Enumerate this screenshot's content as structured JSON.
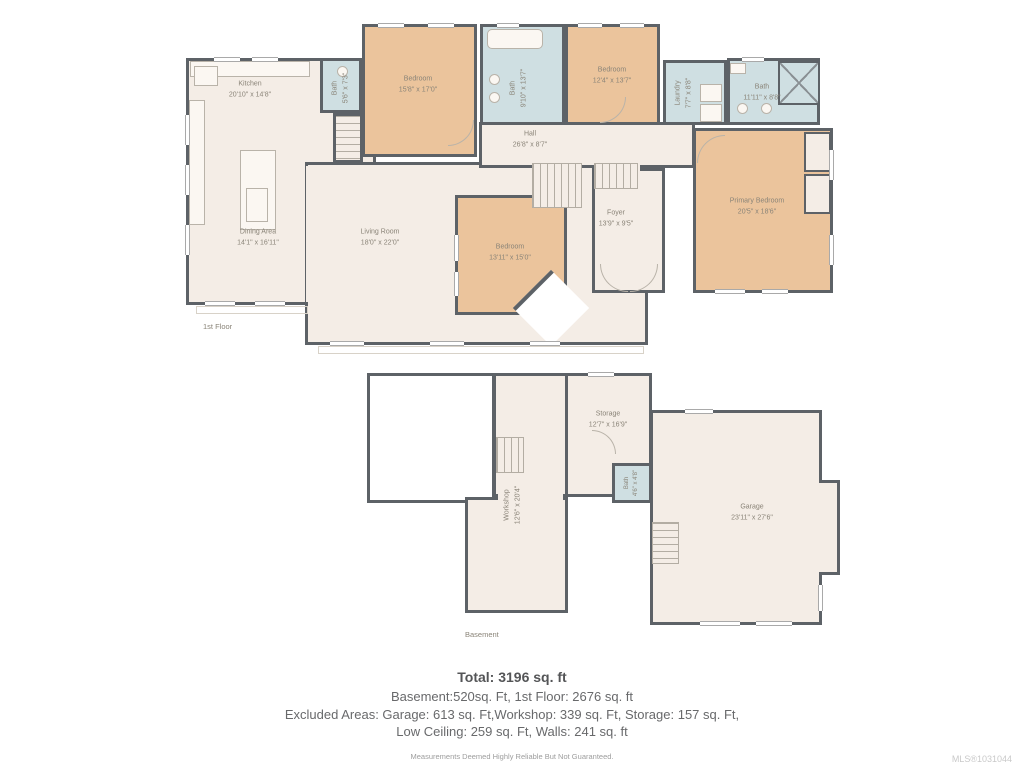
{
  "floors": {
    "first": {
      "label": "1st Floor",
      "rooms": {
        "kitchen": {
          "name": "Kitchen",
          "dims": "20'10\" x 14'8\""
        },
        "dining": {
          "name": "Dining Area",
          "dims": "14'1\" x 16'11\""
        },
        "living": {
          "name": "Living Room",
          "dims": "18'0\" x 22'0\""
        },
        "bath_small": {
          "name": "Bath",
          "dims": "5'6\" x 7'3\""
        },
        "bedroom1": {
          "name": "Bedroom",
          "dims": "15'8\" x 17'0\""
        },
        "bath_main": {
          "name": "Bath",
          "dims": "9'10\" x 13'7\""
        },
        "bedroom2": {
          "name": "Bedroom",
          "dims": "12'4\" x 13'7\""
        },
        "laundry": {
          "name": "Laundry",
          "dims": "7'7\" x 8'8\""
        },
        "bath_right": {
          "name": "Bath",
          "dims": "11'11\" x 8'8\""
        },
        "hall": {
          "name": "Hall",
          "dims": "26'8\" x 8'7\""
        },
        "foyer": {
          "name": "Foyer",
          "dims": "13'9\" x 9'5\""
        },
        "bedroom3": {
          "name": "Bedroom",
          "dims": "13'11\" x 15'0\""
        },
        "primary": {
          "name": "Primary Bedroom",
          "dims": "20'5\" x 18'6\""
        }
      }
    },
    "basement": {
      "label": "Basement",
      "rooms": {
        "workshop": {
          "name": "Workshop",
          "dims": "12'6\" x 20'4\""
        },
        "storage": {
          "name": "Storage",
          "dims": "12'7\" x 16'9\""
        },
        "bath": {
          "name": "Bath",
          "dims": "4'6\" x 4'8\""
        },
        "garage": {
          "name": "Garage",
          "dims": "23'11\" x 27'6\""
        }
      }
    }
  },
  "summary": {
    "total": "Total: 3196 sq. ft",
    "line1": "Basement:520sq. Ft, 1st Floor: 2676 sq. ft",
    "line2": "Excluded Areas: Garage: 613 sq. Ft,Workshop: 339 sq. Ft, Storage: 157 sq. Ft,",
    "line3": "Low Ceiling: 259 sq. Ft, Walls: 241 sq. ft",
    "disclaimer": "Measurements Deemed Highly Reliable But Not Guaranteed.",
    "mls": "MLS®1031044"
  },
  "colors": {
    "wall": "#5d6267",
    "floor": "#f4ede6",
    "bedroom_fill": "#ebc49c",
    "bath_fill": "#cfdfe2",
    "background": "#ffffff"
  }
}
